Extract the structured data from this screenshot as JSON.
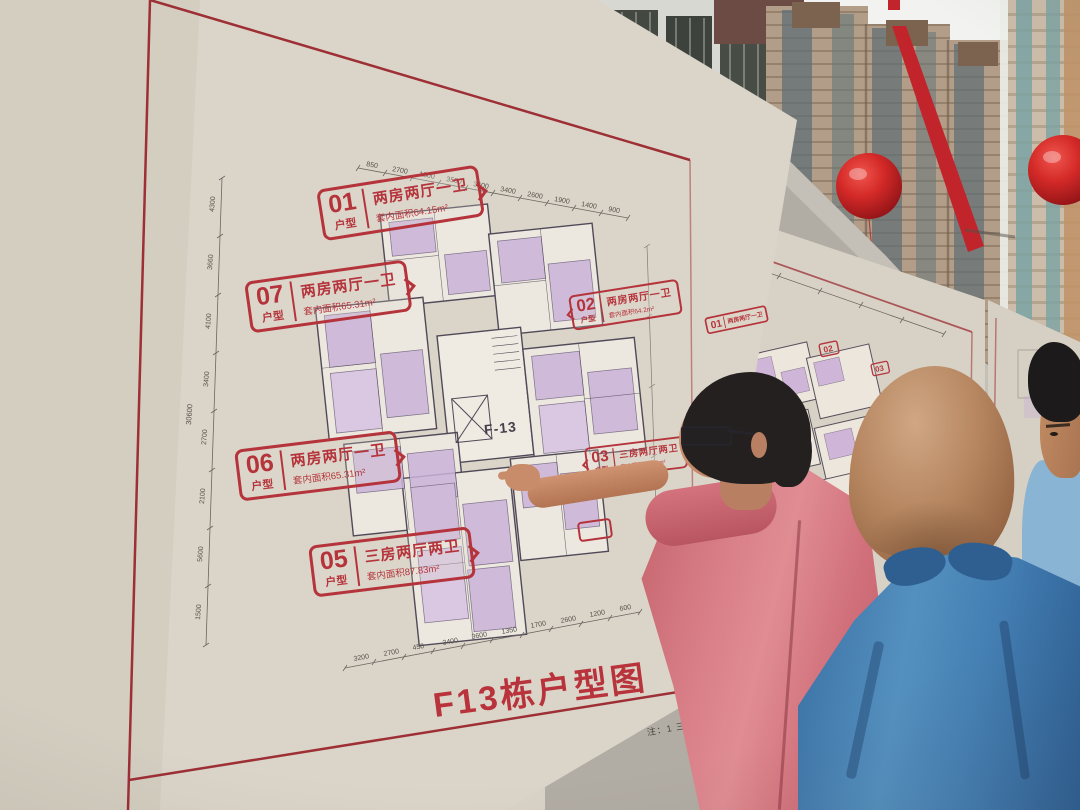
{
  "board1": {
    "title": "F13栋户型图",
    "building_label": "F-13",
    "note": "注：1 三层至顶层户型图",
    "unit_labels": [
      {
        "num": "01",
        "tag": "户型",
        "desc": "两房两厅一卫",
        "area": "套内面积64.15m²"
      },
      {
        "num": "07",
        "tag": "户型",
        "desc": "两房两厅一卫",
        "area": "套内面积65.31m²"
      },
      {
        "num": "02",
        "tag": "户型",
        "desc": "两房两厅一卫",
        "area": "套内面积64.2m²"
      },
      {
        "num": "06",
        "tag": "户型",
        "desc": "两房两厅一卫",
        "area": "套内面积65.31m²"
      },
      {
        "num": "03",
        "tag": "户型",
        "desc": "三房两厅两卫",
        "area": "套内面积87.83m²"
      },
      {
        "num": "05",
        "tag": "户型",
        "desc": "三房两厅两卫",
        "area": "套内面积87.83m²"
      }
    ],
    "dims": {
      "left": [
        "4300",
        "3660",
        "4100",
        "3400",
        "2700",
        "2100",
        "5600",
        "1500"
      ],
      "left_total": "30600",
      "top": [
        "850",
        "2700",
        "1300",
        "3500",
        "3600",
        "3400",
        "2600",
        "1900",
        "1400",
        "900"
      ],
      "bottom": [
        "3200",
        "2700",
        "450",
        "3400",
        "3600",
        "1350",
        "1700",
        "2600",
        "1200",
        "600"
      ]
    }
  },
  "board2": {
    "labels": [
      {
        "num": "01",
        "desc": "两房两厅一卫"
      },
      {
        "num": "02",
        "desc": ""
      },
      {
        "num": "03",
        "desc": ""
      },
      {
        "num": "06",
        "desc": ""
      }
    ]
  },
  "colors": {
    "board_beige": "#d9d3c7",
    "board_border_red": "#9d2f35",
    "label_red": "#b5343c",
    "title_red": "#b8333b",
    "plan_purple": "#cbb3da",
    "wall_gray": "#b1aca4",
    "balloon_red": "#cf2428",
    "ribbon_red": "#c2242b",
    "shirt_pink": "#d97f88",
    "shirt_blue": "#4a82ae",
    "shirt_lightblue": "#8ab4d4"
  }
}
